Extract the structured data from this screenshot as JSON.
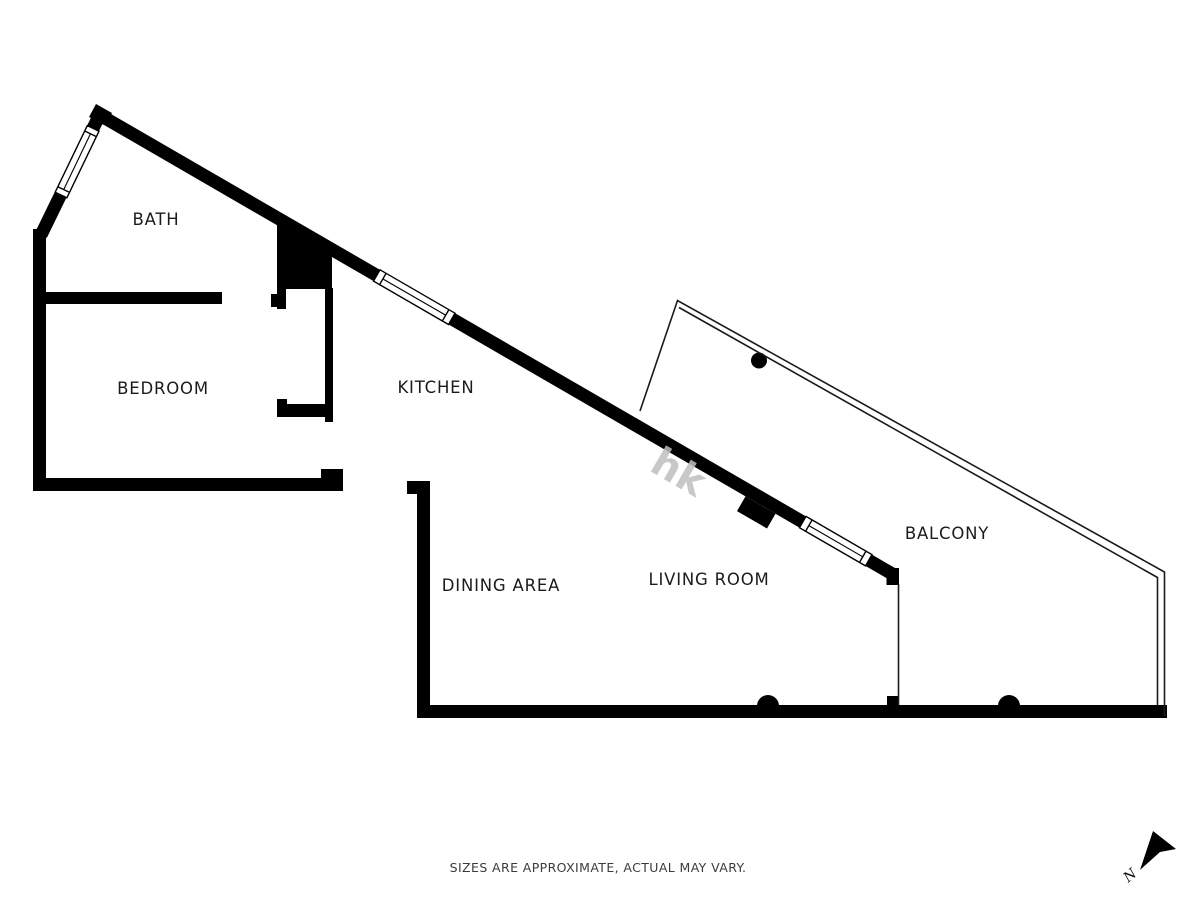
{
  "background_color": "#ffffff",
  "colors": {
    "walls": "#000000",
    "thin_lines": "#1a1a1a",
    "labels": "#1b1b1b",
    "disclaimer": "#3c3c3c",
    "watermark": "#bfbfbf",
    "compass": "#111111"
  },
  "rooms": [
    {
      "name": "bath",
      "label": "BATH"
    },
    {
      "name": "bedroom",
      "label": "BEDROOM"
    },
    {
      "name": "kitchen",
      "label": "KITCHEN"
    },
    {
      "name": "dining-area",
      "label": "DINING AREA"
    },
    {
      "name": "living-room",
      "label": "LIVING ROOM"
    },
    {
      "name": "balcony",
      "label": "BALCONY"
    }
  ],
  "disclaimer": "SIZES ARE APPROXIMATE, ACTUAL MAY VARY.",
  "compass": {
    "label": "N"
  },
  "watermark": {
    "text": "hk"
  }
}
